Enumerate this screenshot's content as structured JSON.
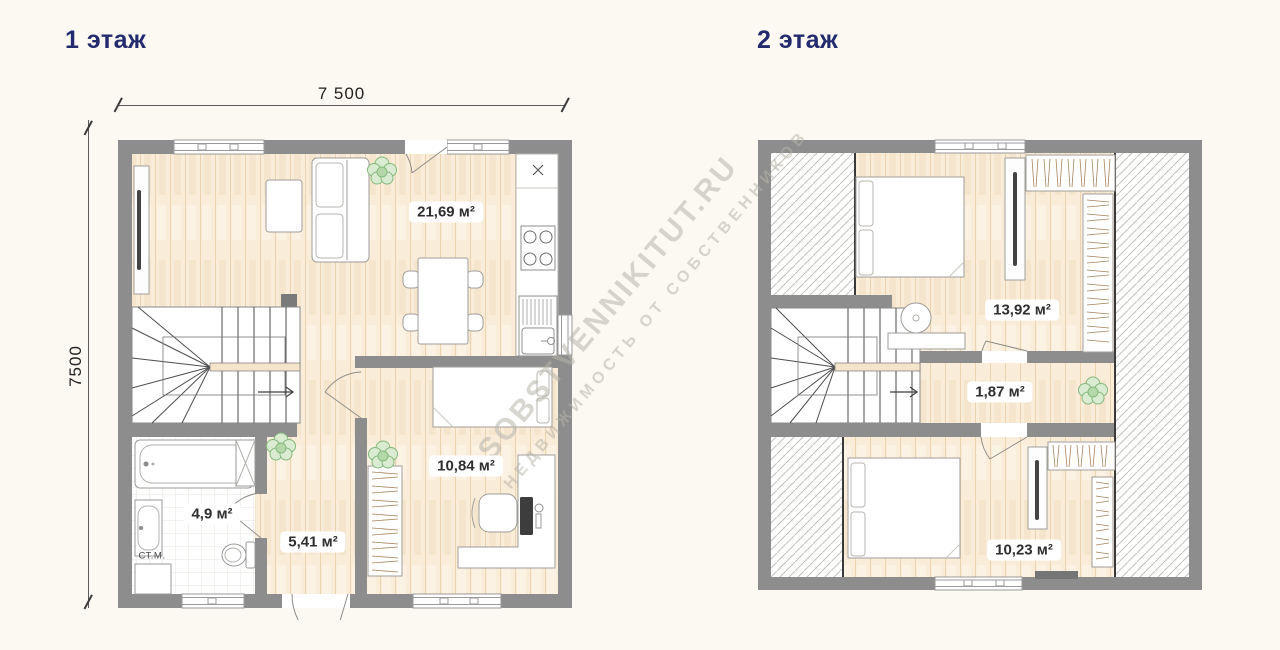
{
  "floor1": {
    "title": "1 этаж",
    "dimensions": {
      "width": "7 500",
      "height": "7500"
    },
    "rooms": {
      "living_kitchen": {
        "area": "21,69 м²"
      },
      "bedroom": {
        "area": "10,84 м²"
      },
      "bathroom": {
        "area": "4,9 м²",
        "washer_label": "СТ.М."
      },
      "hallway": {
        "area": "5,41 м²"
      }
    }
  },
  "floor2": {
    "title": "2 этаж",
    "rooms": {
      "bedroom_top": {
        "area": "13,92 м²"
      },
      "hall": {
        "area": "1,87 м²"
      },
      "bedroom_bottom": {
        "area": "10,23 м²"
      }
    }
  },
  "watermark": {
    "line1": "SOBSTVENNIKITUT.RU",
    "line2": "НЕДВИЖИМОСТЬ ОТ СОБСТВЕННИКОВ"
  },
  "colors": {
    "background": "#fbf9f2",
    "wall": "#8d8d8d",
    "wood": "#f8ead9",
    "title": "#232a6e",
    "plant": "#8fbc85",
    "watermark": "#b8b4aa"
  }
}
